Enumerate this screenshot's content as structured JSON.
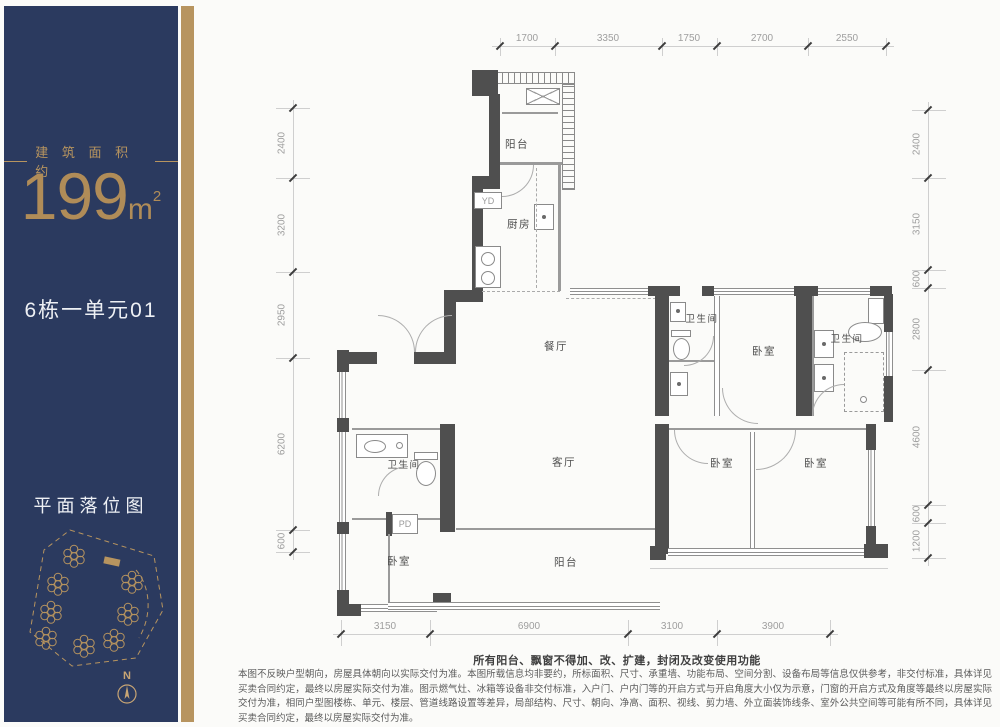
{
  "sidebar": {
    "area_caption": "建 筑 面 积 约",
    "area_value": "199",
    "area_unit": "m",
    "area_sup": "2",
    "unit_name": "6栋一单元01",
    "siteplan_title": "平面落位图",
    "north_label": "N"
  },
  "plan": {
    "rooms": {
      "balcony_top": "阳台",
      "kitchen": "厨房",
      "dining": "餐厅",
      "bath_mid": "卫生间",
      "bed_top": "卧室",
      "bath_right": "卫生间",
      "living": "客厅",
      "bath_left": "卫生间",
      "bed_left": "卧室",
      "balcony_bottom": "阳台",
      "bed_bottom_mid": "卧室",
      "bed_bottom_right": "卧室"
    },
    "shafts": {
      "yd": "YD",
      "pd": "PD"
    },
    "dims": {
      "top": [
        "1700",
        "3350",
        "1750",
        "2700",
        "2550"
      ],
      "right": [
        "2400",
        "3150",
        "600",
        "2800",
        "4600",
        "600",
        "1200"
      ],
      "left": [
        "2400",
        "3200",
        "2950",
        "6200",
        "600"
      ],
      "bottom": [
        "3150",
        "6900",
        "3100",
        "3900"
      ]
    }
  },
  "disclaimer": {
    "headline": "所有阳台、飘窗不得加、改、扩建，封闭及改变使用功能",
    "body": "本图不反映户型朝向，房屋具体朝向以实际交付为准。本图所载信息均非要约，所标面积、尺寸、承重墙、功能布局、空间分割、设备布局等信息仅供参考，非交付标准，具体详见买卖合同约定，最终以房屋实际交付为准。图示燃气灶、冰箱等设备非交付标准，入户门、户内门等的开启方式与开启角度大小仅为示意，门窗的开启方式及角度等最终以房屋实际交付为准，相同户型图楼栋、单元、楼层、管道线路设置等差异，局部结构、尺寸、朝向、净高、面积、视线、剪力墙、外立面装饰线条、室外公共空间等可能有所不同，具体详见买卖合同约定，最终以房屋实际交付为准。"
  }
}
